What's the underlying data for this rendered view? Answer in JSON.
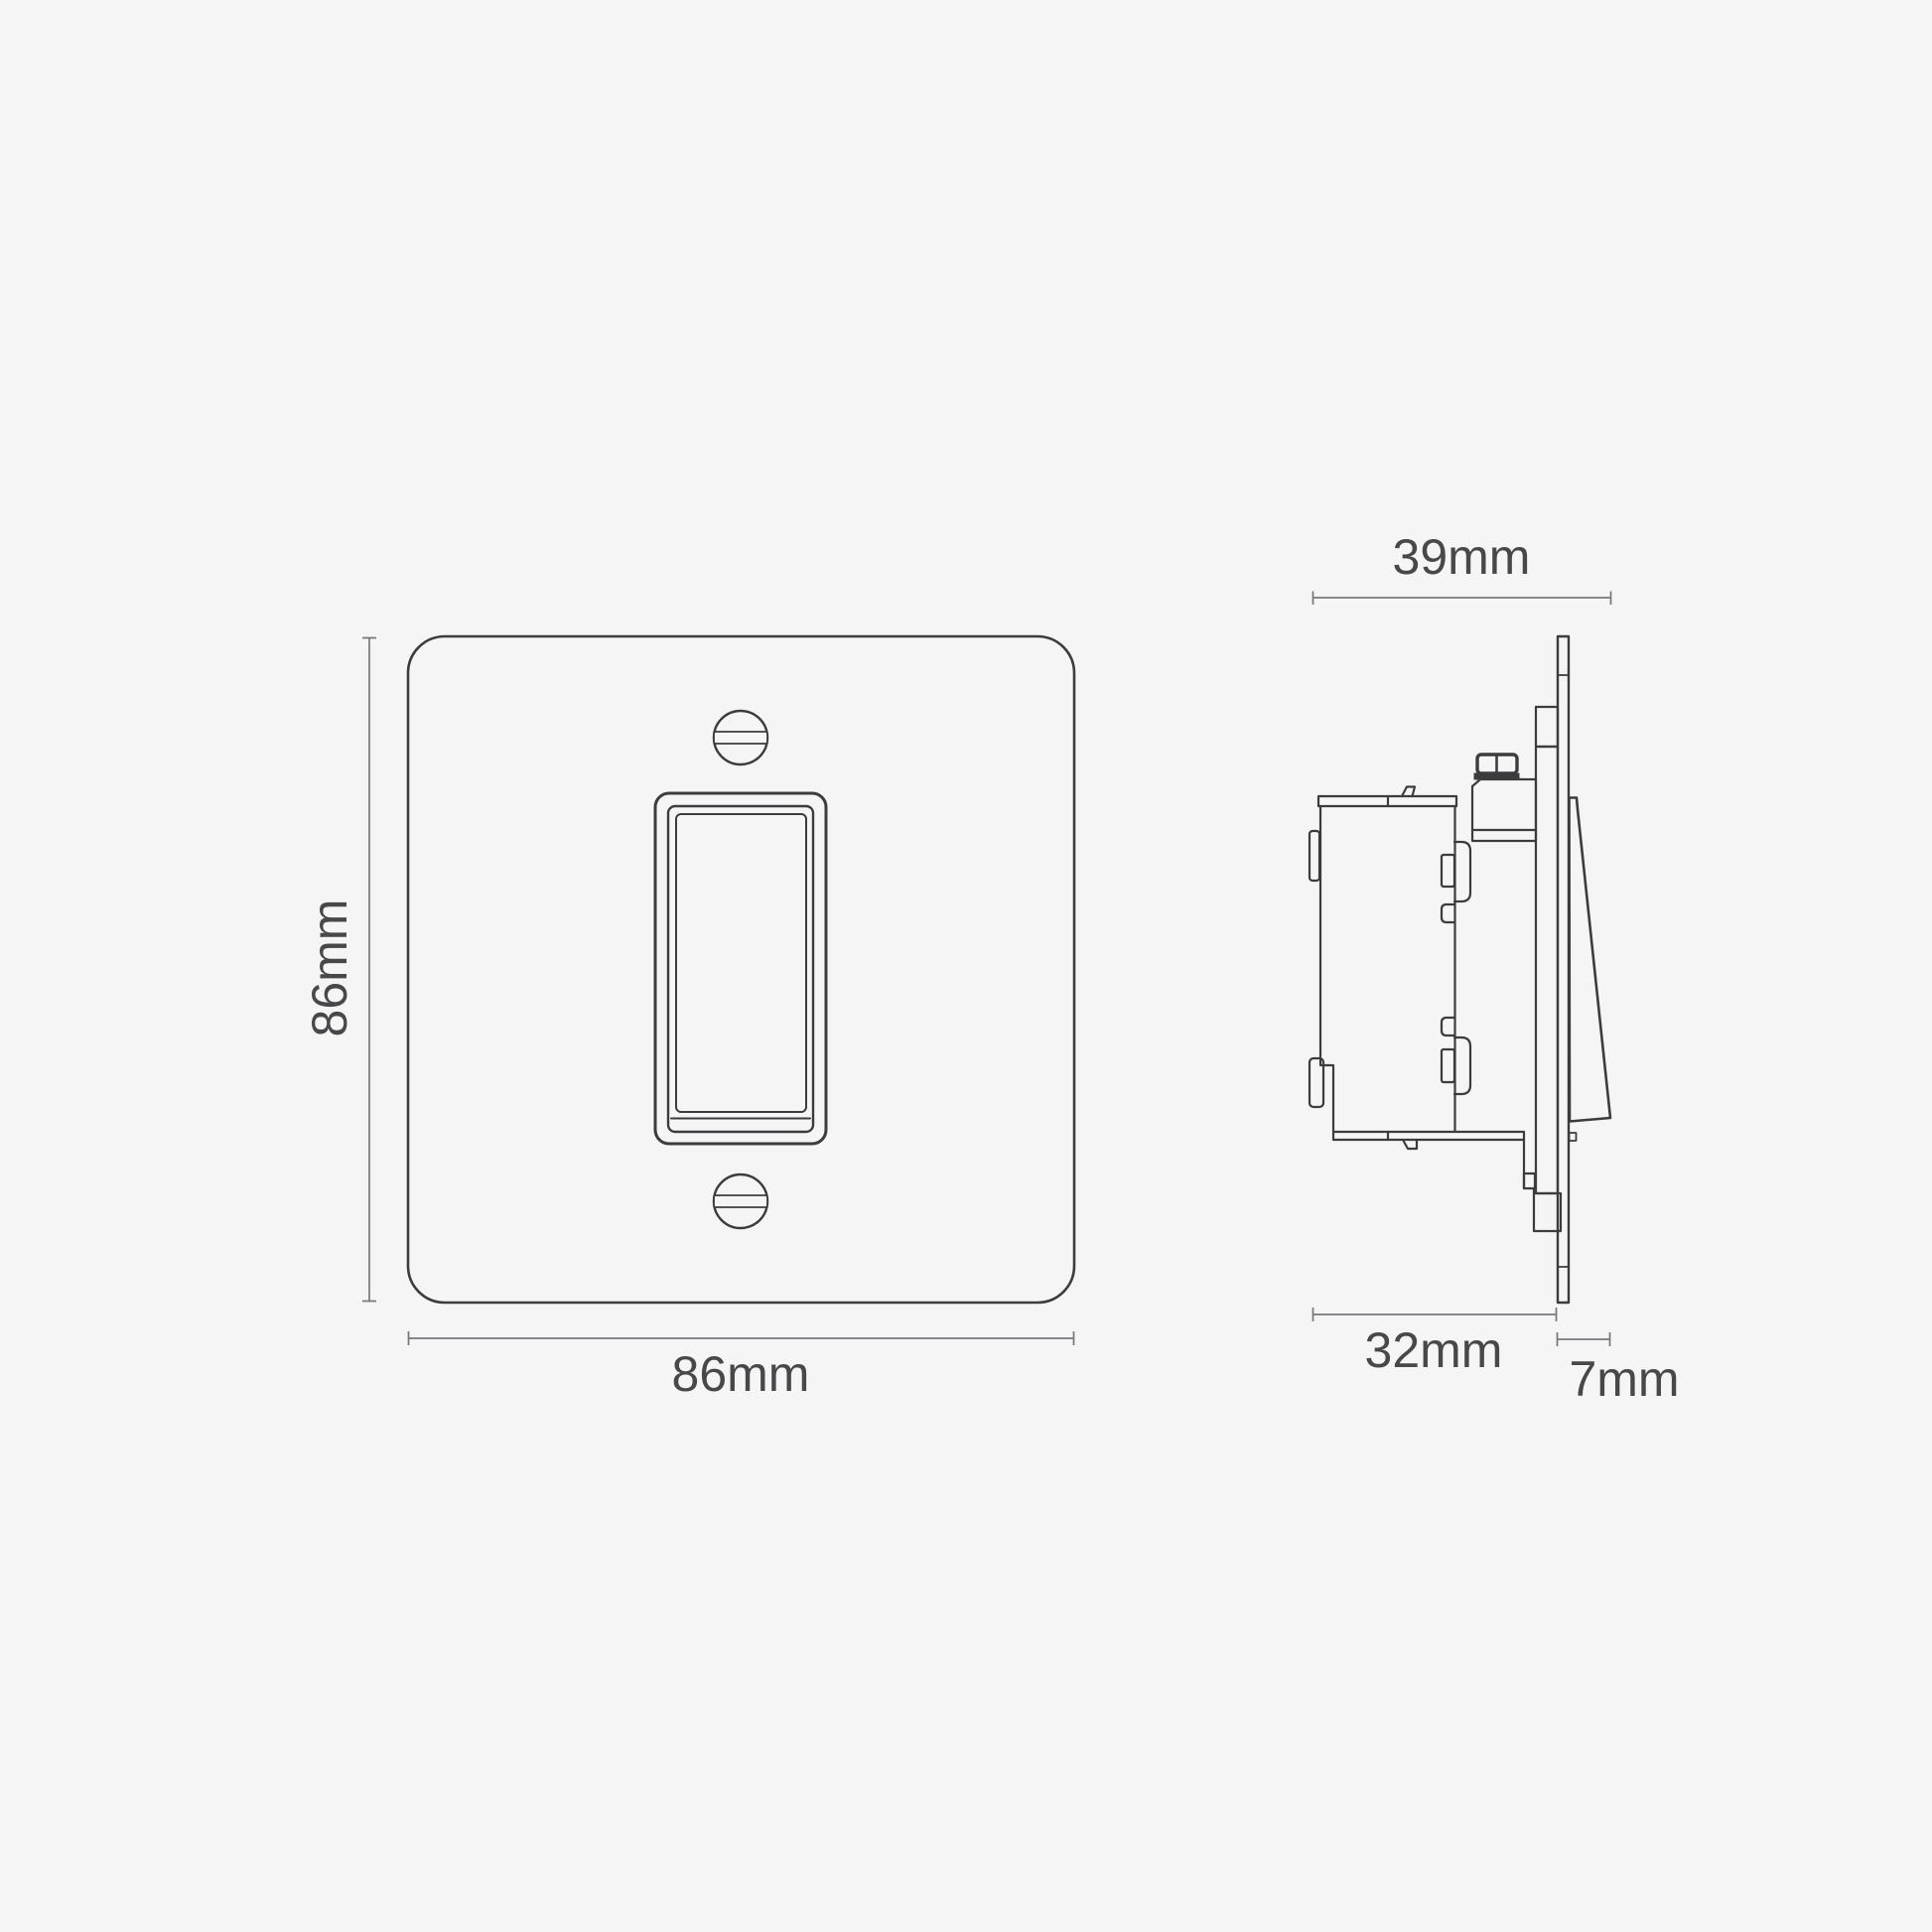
{
  "colors": {
    "background": "#f5f5f6",
    "line": "#3c3c3e",
    "dimension": "#76777a",
    "text": "#48484a"
  },
  "front_view": {
    "height_label": "86mm",
    "width_label": "86mm"
  },
  "side_view": {
    "depth_total_label": "39mm",
    "depth_box_label": "32mm",
    "depth_plate_label": "7mm"
  }
}
